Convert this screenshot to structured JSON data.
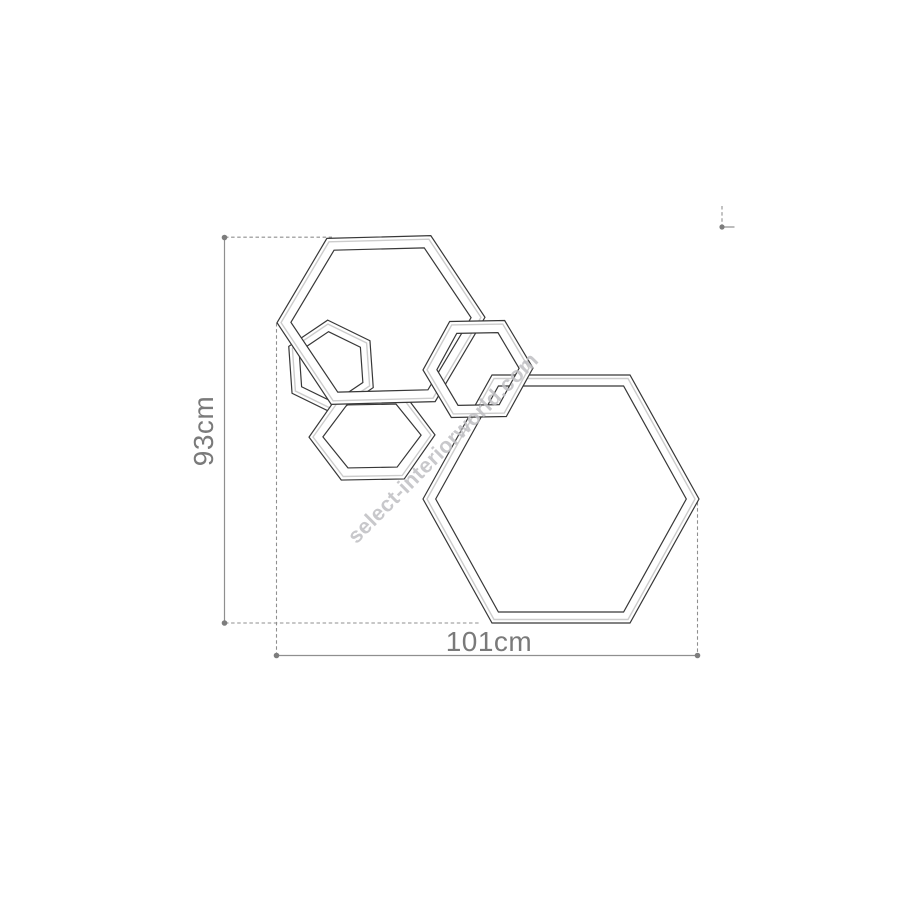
{
  "figure": {
    "dimensions": {
      "height_label": "93cm",
      "width_label": "101cm"
    },
    "watermark": {
      "text": "select-interiorworld.com",
      "angle_deg": -45
    },
    "colors": {
      "background": "#ffffff",
      "outline": "#383838",
      "bevel": "#cccccc",
      "dimension_line": "#8f8f8f",
      "label_text": "#7a7a7a",
      "watermark_text": "#bfbfc3"
    },
    "hexagons": [
      {
        "name": "hexagon-small-left",
        "type": "pointy",
        "cx": 331,
        "cy": 367,
        "r": 47,
        "thickness": 10,
        "rotation": -4
      },
      {
        "name": "hexagon-medium-bottom-left",
        "type": "flat",
        "cx": 372,
        "cy": 436,
        "rx": 63,
        "h": 43.5,
        "thickness": 12,
        "rotation": -1
      },
      {
        "name": "hexagon-large-bottom-right",
        "type": "flat",
        "cx": 561,
        "cy": 499,
        "rx": 138,
        "h": 124,
        "thickness": 11,
        "rotation": 0
      },
      {
        "name": "hexagon-large-top-left",
        "type": "flat",
        "cx": 381,
        "cy": 320,
        "rx": 104,
        "h": 83,
        "thickness": 12,
        "rotation": -1.5
      },
      {
        "name": "hexagon-medium-center",
        "type": "flat",
        "cx": 478,
        "cy": 369,
        "rx": 55,
        "h": 48,
        "thickness": 12,
        "rotation": -1
      }
    ]
  }
}
